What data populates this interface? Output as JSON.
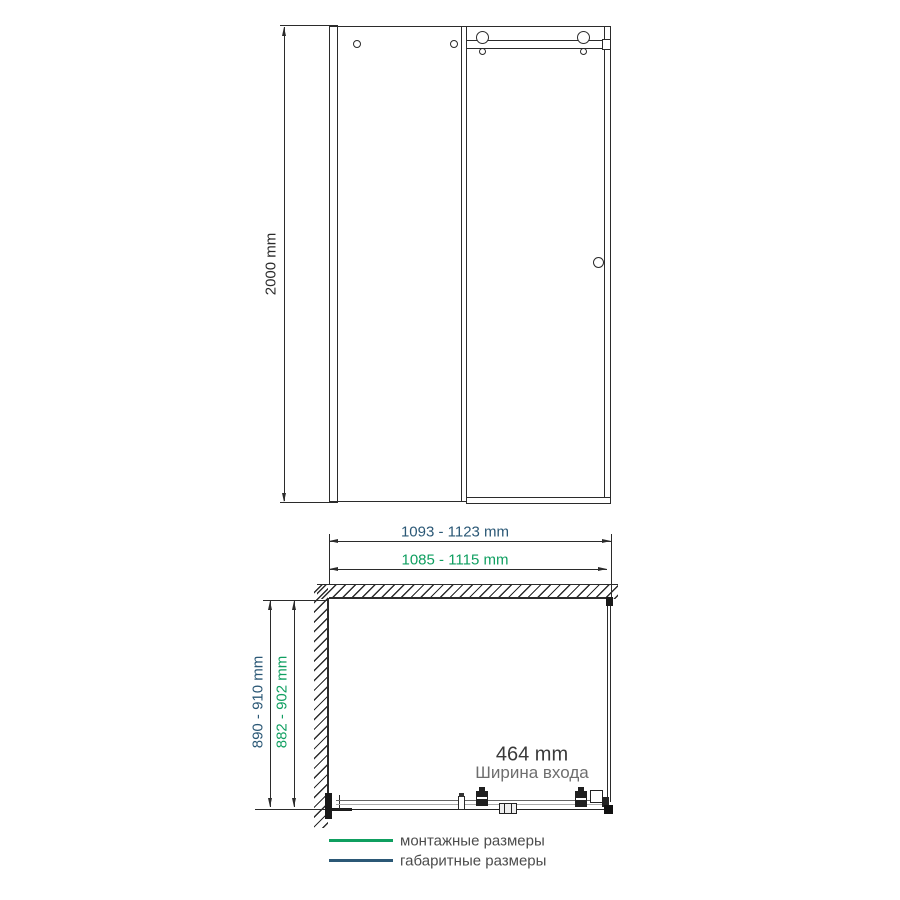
{
  "title": "Shower enclosure dimension diagram",
  "colors": {
    "ink": "#2b2b2b",
    "navy": "#2b5876",
    "green": "#0f9f60",
    "entrance_text": "#3a3a3a",
    "caption_text": "#6e6e6e",
    "legend_text": "#4c4c4c"
  },
  "front": {
    "height_label": "2000 mm"
  },
  "plan": {
    "overall_width_label": "1093 - 1123 mm",
    "mounting_width_label": "1085 - 1115 mm",
    "overall_depth_label": "890 - 910 mm",
    "mounting_depth_label": "882 - 902 mm",
    "entrance_value": "464 mm",
    "entrance_caption": "Ширина входа"
  },
  "legend": {
    "items": [
      {
        "label": "монтажные размеры",
        "color": "#0f9f60"
      },
      {
        "label": "габаритные размеры",
        "color": "#2b5876"
      }
    ]
  }
}
